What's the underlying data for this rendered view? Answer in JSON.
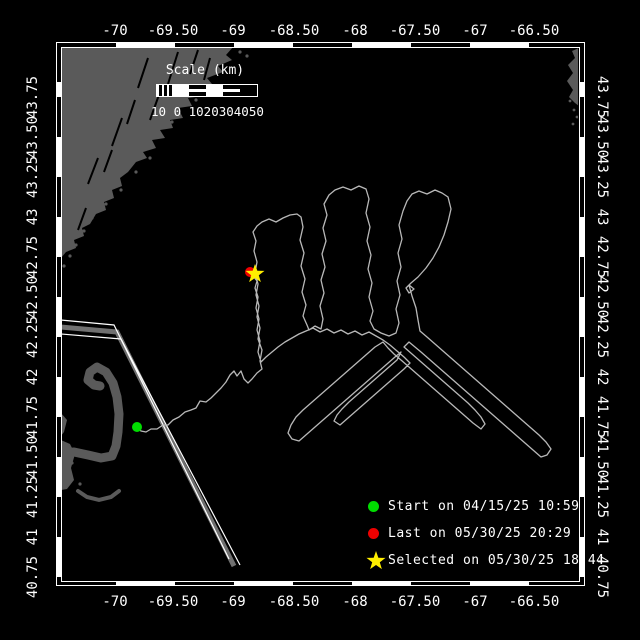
{
  "map": {
    "bg": "#000000",
    "land_color": "#5a5a5a",
    "track_color": "#b8b8b8",
    "corridor_core_color": "#707070",
    "neatline_color": "#ffffff"
  },
  "axis": {
    "lon_labels": [
      "-70",
      "-69.50",
      "-69",
      "-68.50",
      "-68",
      "-67.50",
      "-67",
      "-66.50"
    ],
    "lon_x": [
      115,
      173,
      233,
      294,
      355,
      415,
      475,
      534
    ],
    "lat_labels": [
      "43.75",
      "43.50",
      "43.25",
      "43",
      "42.75",
      "42.50",
      "42.25",
      "42",
      "41.75",
      "41.50",
      "41.25",
      "41",
      "40.75"
    ],
    "lat_y": [
      97,
      137,
      177,
      217,
      257,
      297,
      337,
      377,
      417,
      457,
      497,
      537,
      577
    ]
  },
  "scalebar": {
    "title": "Scale (km)",
    "ticks_text": "10 0 1020304050",
    "segments": [
      "hatch",
      "solid",
      "mid",
      "solid",
      "mid",
      "dark"
    ]
  },
  "legend": {
    "items": [
      {
        "marker": "dot",
        "color": "#00dd00",
        "label": "Start on 04/15/25 10:59"
      },
      {
        "marker": "dot",
        "color": "#ee0000",
        "label": "Last on 05/30/25 20:29"
      },
      {
        "marker": "star",
        "color": "#ffee00",
        "label": "Selected on 05/30/25 18:44"
      }
    ]
  },
  "markers": {
    "start": {
      "x": 137,
      "y": 427,
      "color": "#00dd00",
      "r": 5
    },
    "last": {
      "x": 250,
      "y": 272,
      "color": "#ee0000",
      "r": 5
    },
    "selected": {
      "x": 255,
      "y": 274,
      "color": "#ffee00"
    }
  },
  "geometry": {
    "star_shape": [
      [
        0,
        -10
      ],
      [
        2.35,
        -3.24
      ],
      [
        9.51,
        -3.09
      ],
      [
        3.8,
        1.24
      ],
      [
        5.88,
        8.09
      ],
      [
        0,
        4
      ],
      [
        -5.88,
        8.09
      ],
      [
        -3.8,
        1.24
      ],
      [
        -9.51,
        -3.09
      ],
      [
        -2.35,
        -3.24
      ]
    ],
    "maine_coast": [
      [
        61,
        47
      ],
      [
        233,
        47
      ],
      [
        226,
        55
      ],
      [
        232,
        60
      ],
      [
        218,
        66
      ],
      [
        223,
        72
      ],
      [
        207,
        78
      ],
      [
        212,
        84
      ],
      [
        198,
        88
      ],
      [
        203,
        96
      ],
      [
        188,
        98
      ],
      [
        192,
        106
      ],
      [
        178,
        108
      ],
      [
        183,
        118
      ],
      [
        170,
        120
      ],
      [
        173,
        128
      ],
      [
        160,
        130
      ],
      [
        165,
        138
      ],
      [
        152,
        140
      ],
      [
        156,
        148
      ],
      [
        143,
        152
      ],
      [
        147,
        158
      ],
      [
        136,
        162
      ],
      [
        128,
        172
      ],
      [
        120,
        178
      ],
      [
        122,
        186
      ],
      [
        112,
        190
      ],
      [
        114,
        198
      ],
      [
        104,
        202
      ],
      [
        106,
        210
      ],
      [
        96,
        214
      ],
      [
        90,
        224
      ],
      [
        82,
        228
      ],
      [
        84,
        236
      ],
      [
        74,
        240
      ],
      [
        76,
        248
      ],
      [
        66,
        252
      ],
      [
        61,
        258
      ]
    ],
    "maine_slashes": [
      [
        148,
        58,
        138,
        88
      ],
      [
        178,
        52,
        168,
        84
      ],
      [
        198,
        50,
        190,
        74
      ],
      [
        122,
        118,
        112,
        146
      ],
      [
        98,
        158,
        88,
        184
      ],
      [
        160,
        92,
        150,
        120
      ],
      [
        135,
        100,
        127,
        124
      ],
      [
        86,
        208,
        78,
        230
      ],
      [
        210,
        58,
        204,
        80
      ],
      [
        112,
        150,
        104,
        172
      ]
    ],
    "islands": [
      [
        196,
        100
      ],
      [
        210,
        92
      ],
      [
        172,
        122
      ],
      [
        158,
        134
      ],
      [
        144,
        150
      ],
      [
        128,
        164
      ],
      [
        117,
        180
      ],
      [
        108,
        192
      ],
      [
        99,
        205
      ],
      [
        92,
        218
      ],
      [
        84,
        231
      ],
      [
        76,
        245
      ],
      [
        70,
        256
      ],
      [
        64,
        266
      ],
      [
        150,
        158
      ],
      [
        136,
        172
      ],
      [
        121,
        190
      ],
      [
        106,
        204
      ],
      [
        240,
        52
      ],
      [
        247,
        56
      ]
    ],
    "nova_scotia": [
      [
        579,
        48
      ],
      [
        572,
        51
      ],
      [
        575,
        58
      ],
      [
        568,
        65
      ],
      [
        573,
        73
      ],
      [
        567,
        81
      ],
      [
        573,
        90
      ],
      [
        569,
        97
      ],
      [
        575,
        103
      ],
      [
        579,
        106
      ]
    ],
    "ns_islands": [
      [
        574,
        110
      ],
      [
        577,
        117
      ],
      [
        570,
        101
      ],
      [
        573,
        124
      ]
    ],
    "cape_arm": [
      [
        61,
        453
      ],
      [
        74,
        452
      ],
      [
        88,
        455
      ],
      [
        101,
        458
      ],
      [
        112,
        456
      ],
      [
        116,
        446
      ],
      [
        118,
        432
      ],
      [
        119,
        414
      ],
      [
        117,
        397
      ],
      [
        113,
        383
      ],
      [
        106,
        372
      ],
      [
        97,
        367
      ],
      [
        90,
        372
      ],
      [
        88,
        380
      ],
      [
        94,
        385
      ],
      [
        100,
        386
      ]
    ],
    "cape_blob": [
      [
        61,
        440
      ],
      [
        70,
        444
      ],
      [
        75,
        454
      ],
      [
        71,
        468
      ],
      [
        74,
        480
      ],
      [
        67,
        489
      ],
      [
        61,
        490
      ]
    ],
    "cape_strip": [
      [
        61,
        413
      ],
      [
        67,
        420
      ],
      [
        64,
        432
      ],
      [
        61,
        436
      ]
    ],
    "cape_crescent": [
      [
        78,
        491
      ],
      [
        87,
        497
      ],
      [
        99,
        500
      ],
      [
        111,
        497
      ],
      [
        119,
        491
      ]
    ],
    "cape_dots": [
      [
        67,
        470
      ],
      [
        72,
        463
      ],
      [
        80,
        484
      ]
    ],
    "corridor_core": [
      [
        61,
        327
      ],
      [
        117,
        332
      ],
      [
        234,
        566
      ]
    ],
    "corridor_edge_a": [
      [
        61,
        320
      ],
      [
        114,
        325
      ],
      [
        229,
        559
      ]
    ],
    "corridor_edge_b": [
      [
        61,
        334
      ],
      [
        121,
        339
      ],
      [
        240,
        565
      ]
    ],
    "track": [
      [
        137,
        427
      ],
      [
        141,
        431
      ],
      [
        146,
        432
      ],
      [
        151,
        429
      ],
      [
        157,
        429
      ],
      [
        163,
        425
      ],
      [
        168,
        425
      ],
      [
        173,
        420
      ],
      [
        179,
        417
      ],
      [
        185,
        412
      ],
      [
        191,
        410
      ],
      [
        196,
        408
      ],
      [
        200,
        401
      ],
      [
        206,
        402
      ],
      [
        211,
        398
      ],
      [
        216,
        393
      ],
      [
        221,
        388
      ],
      [
        226,
        382
      ],
      [
        230,
        375
      ],
      [
        234,
        371
      ],
      [
        237,
        376
      ],
      [
        241,
        371
      ],
      [
        244,
        379
      ],
      [
        248,
        383
      ],
      [
        252,
        379
      ],
      [
        257,
        373
      ],
      [
        262,
        369
      ],
      [
        260,
        361
      ],
      [
        262,
        350
      ],
      [
        258,
        339
      ],
      [
        260,
        328
      ],
      [
        257,
        317
      ],
      [
        259,
        306
      ],
      [
        256,
        295
      ],
      [
        258,
        284
      ],
      [
        255,
        273
      ],
      [
        257,
        262
      ],
      [
        254,
        251
      ],
      [
        256,
        241
      ],
      [
        253,
        232
      ],
      [
        257,
        226
      ],
      [
        262,
        222
      ],
      [
        269,
        219
      ],
      [
        276,
        222
      ],
      [
        283,
        218
      ],
      [
        290,
        215
      ],
      [
        297,
        214
      ],
      [
        301,
        217
      ],
      [
        303,
        227
      ],
      [
        300,
        240
      ],
      [
        304,
        253
      ],
      [
        301,
        266
      ],
      [
        305,
        279
      ],
      [
        302,
        292
      ],
      [
        306,
        305
      ],
      [
        303,
        316
      ],
      [
        307,
        325
      ],
      [
        309,
        330
      ],
      [
        315,
        326
      ],
      [
        321,
        329
      ],
      [
        323,
        319
      ],
      [
        320,
        306
      ],
      [
        324,
        293
      ],
      [
        321,
        280
      ],
      [
        325,
        267
      ],
      [
        322,
        254
      ],
      [
        326,
        241
      ],
      [
        323,
        228
      ],
      [
        327,
        215
      ],
      [
        324,
        204
      ],
      [
        329,
        195
      ],
      [
        335,
        190
      ],
      [
        343,
        187
      ],
      [
        351,
        190
      ],
      [
        359,
        186
      ],
      [
        366,
        189
      ],
      [
        369,
        199
      ],
      [
        366,
        213
      ],
      [
        370,
        227
      ],
      [
        367,
        241
      ],
      [
        371,
        255
      ],
      [
        368,
        269
      ],
      [
        372,
        283
      ],
      [
        369,
        297
      ],
      [
        373,
        311
      ],
      [
        370,
        321
      ],
      [
        374,
        329
      ],
      [
        381,
        333
      ],
      [
        389,
        336
      ],
      [
        396,
        333
      ],
      [
        399,
        323
      ],
      [
        396,
        309
      ],
      [
        400,
        295
      ],
      [
        397,
        281
      ],
      [
        401,
        267
      ],
      [
        398,
        253
      ],
      [
        402,
        239
      ],
      [
        399,
        225
      ],
      [
        403,
        211
      ],
      [
        407,
        201
      ],
      [
        412,
        194
      ],
      [
        419,
        191
      ],
      [
        427,
        194
      ],
      [
        435,
        190
      ],
      [
        442,
        193
      ],
      [
        448,
        197
      ],
      [
        451,
        209
      ],
      [
        448,
        222
      ],
      [
        444,
        235
      ],
      [
        439,
        247
      ],
      [
        433,
        258
      ],
      [
        426,
        268
      ],
      [
        418,
        277
      ],
      [
        411,
        283
      ],
      [
        406,
        288
      ],
      [
        409,
        293
      ],
      [
        414,
        289
      ],
      [
        409,
        285
      ],
      [
        412,
        296
      ],
      [
        416,
        308
      ],
      [
        418,
        320
      ],
      [
        420,
        331
      ],
      [
        427,
        337
      ],
      [
        435,
        344
      ],
      [
        443,
        351
      ],
      [
        451,
        358
      ],
      [
        459,
        365
      ],
      [
        467,
        372
      ],
      [
        475,
        379
      ],
      [
        483,
        386
      ],
      [
        491,
        393
      ],
      [
        499,
        400
      ],
      [
        507,
        407
      ],
      [
        515,
        414
      ],
      [
        523,
        421
      ],
      [
        531,
        428
      ],
      [
        539,
        435
      ],
      [
        546,
        442
      ],
      [
        551,
        449
      ],
      [
        547,
        455
      ],
      [
        541,
        457
      ],
      [
        533,
        450
      ],
      [
        525,
        443
      ],
      [
        517,
        436
      ],
      [
        509,
        429
      ],
      [
        501,
        422
      ],
      [
        493,
        415
      ],
      [
        485,
        408
      ],
      [
        477,
        401
      ],
      [
        469,
        394
      ],
      [
        461,
        387
      ],
      [
        453,
        380
      ],
      [
        445,
        373
      ],
      [
        437,
        366
      ],
      [
        429,
        359
      ],
      [
        421,
        352
      ],
      [
        415,
        347
      ],
      [
        409,
        342
      ],
      [
        404,
        347
      ],
      [
        412,
        354
      ],
      [
        420,
        361
      ],
      [
        428,
        368
      ],
      [
        436,
        375
      ],
      [
        444,
        382
      ],
      [
        452,
        389
      ],
      [
        460,
        396
      ],
      [
        468,
        403
      ],
      [
        475,
        410
      ],
      [
        481,
        417
      ],
      [
        485,
        424
      ],
      [
        481,
        429
      ],
      [
        473,
        423
      ],
      [
        465,
        416
      ],
      [
        457,
        409
      ],
      [
        449,
        402
      ],
      [
        441,
        395
      ],
      [
        433,
        388
      ],
      [
        425,
        381
      ],
      [
        417,
        374
      ],
      [
        409,
        367
      ],
      [
        401,
        360
      ],
      [
        394,
        354
      ],
      [
        388,
        348
      ],
      [
        383,
        342
      ],
      [
        375,
        347
      ],
      [
        367,
        354
      ],
      [
        359,
        361
      ],
      [
        351,
        368
      ],
      [
        343,
        375
      ],
      [
        335,
        382
      ],
      [
        327,
        389
      ],
      [
        319,
        396
      ],
      [
        311,
        403
      ],
      [
        303,
        410
      ],
      [
        296,
        417
      ],
      [
        291,
        425
      ],
      [
        288,
        433
      ],
      [
        292,
        439
      ],
      [
        299,
        441
      ],
      [
        307,
        434
      ],
      [
        315,
        427
      ],
      [
        323,
        420
      ],
      [
        331,
        413
      ],
      [
        339,
        406
      ],
      [
        347,
        399
      ],
      [
        355,
        392
      ],
      [
        363,
        385
      ],
      [
        371,
        378
      ],
      [
        379,
        371
      ],
      [
        387,
        364
      ],
      [
        395,
        357
      ],
      [
        401,
        352
      ],
      [
        397,
        360
      ],
      [
        389,
        367
      ],
      [
        381,
        374
      ],
      [
        373,
        381
      ],
      [
        365,
        388
      ],
      [
        357,
        395
      ],
      [
        349,
        402
      ],
      [
        342,
        409
      ],
      [
        337,
        415
      ],
      [
        334,
        421
      ],
      [
        340,
        425
      ],
      [
        348,
        418
      ],
      [
        356,
        411
      ],
      [
        364,
        404
      ],
      [
        372,
        397
      ],
      [
        380,
        390
      ],
      [
        388,
        383
      ],
      [
        396,
        376
      ],
      [
        404,
        369
      ],
      [
        410,
        363
      ],
      [
        404,
        357
      ],
      [
        397,
        351
      ],
      [
        390,
        345
      ],
      [
        383,
        340
      ],
      [
        376,
        336
      ],
      [
        369,
        332
      ],
      [
        362,
        335
      ],
      [
        355,
        331
      ],
      [
        348,
        334
      ],
      [
        341,
        330
      ],
      [
        334,
        333
      ],
      [
        327,
        329
      ],
      [
        320,
        332
      ],
      [
        313,
        328
      ],
      [
        306,
        331
      ],
      [
        299,
        334
      ],
      [
        292,
        338
      ],
      [
        285,
        342
      ],
      [
        278,
        347
      ],
      [
        272,
        352
      ],
      [
        266,
        357
      ],
      [
        261,
        362
      ],
      [
        258,
        352
      ],
      [
        260,
        341
      ],
      [
        257,
        330
      ],
      [
        259,
        319
      ],
      [
        256,
        308
      ],
      [
        258,
        297
      ],
      [
        255,
        288
      ],
      [
        257,
        281
      ],
      [
        253,
        276
      ]
    ]
  }
}
